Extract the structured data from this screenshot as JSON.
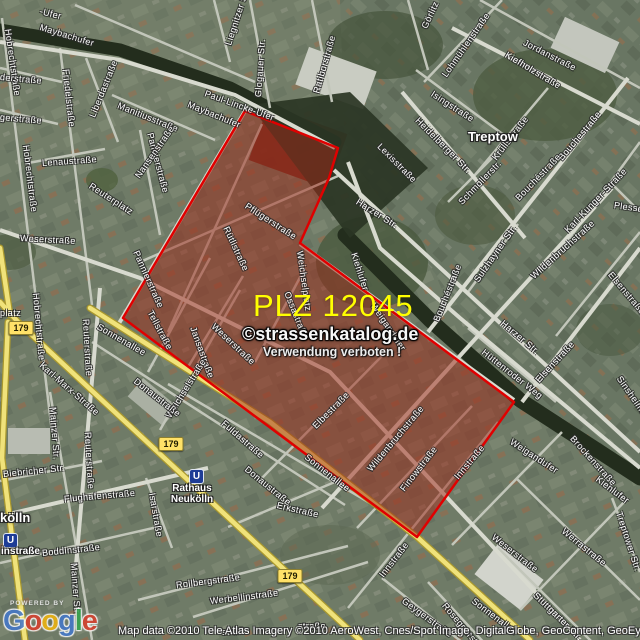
{
  "map": {
    "plz_label": "PLZ 12045",
    "plz_color": "#ffff00",
    "watermark": {
      "line1": "©strassenkatalog.de",
      "line2": "Verwendung verboten !"
    },
    "attribution": "Map data ©2010 Tele Atlas  Imagery ©2010 AeroWest, Cnes/Spot Image, DigitalGlobe, GeoContent, GeoEye,",
    "logo": {
      "powered_by": "POWERED BY",
      "letters": [
        {
          "ch": "G",
          "color": "#4478c9"
        },
        {
          "ch": "o",
          "color": "#d7402e"
        },
        {
          "ch": "o",
          "color": "#efb410"
        },
        {
          "ch": "g",
          "color": "#4478c9"
        },
        {
          "ch": "l",
          "color": "#36a44e"
        },
        {
          "ch": "e",
          "color": "#d7402e"
        }
      ]
    },
    "area_color": "#a02818",
    "area_border_color": "#e00000",
    "area_polygon": "245,111 338,148 329,178 300,243 514,402 417,537 123,318",
    "route_badges": [
      {
        "label": "179",
        "x": 21,
        "y": 328
      },
      {
        "label": "179",
        "x": 171,
        "y": 444
      },
      {
        "label": "179",
        "x": 290,
        "y": 576
      }
    ],
    "stations": [
      {
        "display": "instraße",
        "icon": {
          "x": 3,
          "y": 533
        },
        "label": {
          "x": 1,
          "y": 546,
          "w": 44,
          "align": "left"
        }
      },
      {
        "display": "Rathaus\nNeukölln",
        "icon": {
          "x": 189,
          "y": 469
        },
        "label": {
          "x": 161,
          "y": 483,
          "w": 62,
          "align": "center"
        }
      }
    ],
    "places": [
      {
        "t": "Treptow",
        "x": 468,
        "y": 129
      },
      {
        "t": "kölln",
        "x": 0,
        "y": 510
      }
    ],
    "streets": [
      {
        "t": "-Ufer",
        "x": 40,
        "y": 6,
        "r": 14
      },
      {
        "t": "Maybachufer",
        "x": 40,
        "y": 22,
        "r": 17
      },
      {
        "t": "Hobrechtstraße",
        "x": 8,
        "y": 24,
        "r": 82
      },
      {
        "t": "derstraße",
        "x": 0,
        "y": 72,
        "r": 5
      },
      {
        "t": "gerstraße",
        "x": 0,
        "y": 112,
        "r": 5
      },
      {
        "t": "Hobrechtstraße",
        "x": 26,
        "y": 140,
        "r": 83
      },
      {
        "t": "Friedelstraße",
        "x": 66,
        "y": 64,
        "r": 84
      },
      {
        "t": "Liberdastraße",
        "x": 92,
        "y": 112,
        "r": -68
      },
      {
        "t": "Manitiusstraße",
        "x": 118,
        "y": 100,
        "r": 22
      },
      {
        "t": "Pannierstraße",
        "x": 150,
        "y": 128,
        "r": 75
      },
      {
        "t": "Pannierstraße",
        "x": 136,
        "y": 246,
        "r": 66
      },
      {
        "t": "Liegnitzer Str.",
        "x": 228,
        "y": 40,
        "r": -72
      },
      {
        "t": "Glogauer Str.",
        "x": 258,
        "y": 92,
        "r": -86
      },
      {
        "t": "Ratiborstraße",
        "x": 316,
        "y": 88,
        "r": -74
      },
      {
        "t": "Paul-Lincke-Ufer",
        "x": 205,
        "y": 88,
        "r": 20
      },
      {
        "t": "Maybachufer",
        "x": 188,
        "y": 99,
        "r": 22
      },
      {
        "t": "Görlitz",
        "x": 424,
        "y": 23,
        "r": -65
      },
      {
        "t": "Lohmühlenstraße",
        "x": 444,
        "y": 71,
        "r": -55
      },
      {
        "t": "Jordanstraße",
        "x": 524,
        "y": 37,
        "r": 27
      },
      {
        "t": "Kiefholzstraße",
        "x": 506,
        "y": 49,
        "r": 31
      },
      {
        "t": "Isingstraße",
        "x": 432,
        "y": 88,
        "r": 33
      },
      {
        "t": "Krüllsstraße",
        "x": 494,
        "y": 154,
        "r": -52
      },
      {
        "t": "Heidelberger Str.",
        "x": 417,
        "y": 114,
        "r": 45
      },
      {
        "t": "Bouchestraße",
        "x": 560,
        "y": 154,
        "r": -50
      },
      {
        "t": "Bouchéstraße",
        "x": 517,
        "y": 194,
        "r": -46
      },
      {
        "t": "Bouchéstraße",
        "x": 436,
        "y": 316,
        "r": -68
      },
      {
        "t": "Karl-Kunger-Straße",
        "x": 566,
        "y": 226,
        "r": -46
      },
      {
        "t": "Plesser Str.",
        "x": 614,
        "y": 200,
        "r": 8
      },
      {
        "t": "Schmollerstr.",
        "x": 460,
        "y": 198,
        "r": -46
      },
      {
        "t": "Sulzhayner Str.",
        "x": 476,
        "y": 276,
        "r": -55
      },
      {
        "t": "Wildenbruchstraße",
        "x": 532,
        "y": 272,
        "r": -42
      },
      {
        "t": "Elsenstraße",
        "x": 537,
        "y": 376,
        "r": -47
      },
      {
        "t": "Elsenstraße",
        "x": 610,
        "y": 268,
        "r": 50
      },
      {
        "t": "Harzer Str.",
        "x": 357,
        "y": 196,
        "r": 32
      },
      {
        "t": "Harzer Str.",
        "x": 502,
        "y": 317,
        "r": 40
      },
      {
        "t": "Hüttenroder Weg",
        "x": 483,
        "y": 346,
        "r": 38
      },
      {
        "t": "Kiehlufer",
        "x": 354,
        "y": 248,
        "r": 72
      },
      {
        "t": "Kiehlufer",
        "x": 597,
        "y": 473,
        "r": 37
      },
      {
        "t": "Weigandufer",
        "x": 373,
        "y": 299,
        "r": 56
      },
      {
        "t": "Weigandufer",
        "x": 511,
        "y": 436,
        "r": 33
      },
      {
        "t": "Weichselplatz",
        "x": 300,
        "y": 246,
        "r": 82
      },
      {
        "t": "Sinsheimer Str.",
        "x": 619,
        "y": 372,
        "r": 55
      },
      {
        "t": "Brockenstraße",
        "x": 572,
        "y": 432,
        "r": 48
      },
      {
        "t": "Treptower Str.",
        "x": 619,
        "y": 507,
        "r": 72
      },
      {
        "t": "Lexisstraße",
        "x": 379,
        "y": 140,
        "r": 45
      },
      {
        "t": "Pflügerstraße",
        "x": 246,
        "y": 200,
        "r": 33
      },
      {
        "t": "Rütlistraße",
        "x": 226,
        "y": 222,
        "r": 65
      },
      {
        "t": "Ossastraße",
        "x": 287,
        "y": 287,
        "r": 68
      },
      {
        "t": "Tellstraße",
        "x": 150,
        "y": 306,
        "r": 62
      },
      {
        "t": "Jansastraße",
        "x": 193,
        "y": 322,
        "r": 70
      },
      {
        "t": "Weichselstraße",
        "x": 168,
        "y": 412,
        "r": -58
      },
      {
        "t": "Weserstraße",
        "x": 20,
        "y": 233,
        "r": 3
      },
      {
        "t": "Weserstraße",
        "x": 213,
        "y": 320,
        "r": 43
      },
      {
        "t": "Weserstraße",
        "x": 493,
        "y": 531,
        "r": 38
      },
      {
        "t": "Sonnenallee",
        "x": 98,
        "y": 321,
        "r": 30
      },
      {
        "t": "Sonnenallee",
        "x": 306,
        "y": 451,
        "r": 38
      },
      {
        "t": "Sonnenallee",
        "x": 473,
        "y": 595,
        "r": 37
      },
      {
        "t": "Elbestraße",
        "x": 314,
        "y": 422,
        "r": -45
      },
      {
        "t": "Wildenbruchstraße",
        "x": 369,
        "y": 465,
        "r": -50
      },
      {
        "t": "Finowstraße",
        "x": 402,
        "y": 485,
        "r": -52
      },
      {
        "t": "Innstraße",
        "x": 456,
        "y": 473,
        "r": -50
      },
      {
        "t": "Innstraße",
        "x": 381,
        "y": 571,
        "r": -52
      },
      {
        "t": "Geygerstraße",
        "x": 403,
        "y": 595,
        "r": 36
      },
      {
        "t": "Erkstraße",
        "x": 277,
        "y": 500,
        "r": 13
      },
      {
        "t": "Donaustraße",
        "x": 135,
        "y": 375,
        "r": 38
      },
      {
        "t": "Donaustraße",
        "x": 246,
        "y": 463,
        "r": 39
      },
      {
        "t": "Fuldastraße",
        "x": 223,
        "y": 417,
        "r": 41
      },
      {
        "t": "Karl-Marx-Straße",
        "x": 41,
        "y": 359,
        "r": 41
      },
      {
        "t": "Mainzer Str.",
        "x": 53,
        "y": 402,
        "r": 86
      },
      {
        "t": "Mainzer Str.",
        "x": 74,
        "y": 558,
        "r": 86
      },
      {
        "t": "Reuterstraße",
        "x": 86,
        "y": 314,
        "r": 87
      },
      {
        "t": "Reuterstraße",
        "x": 88,
        "y": 427,
        "r": 87
      },
      {
        "t": "Reuterplatz",
        "x": 90,
        "y": 180,
        "r": 33
      },
      {
        "t": "Lenaustraße",
        "x": 42,
        "y": 158,
        "r": -4
      },
      {
        "t": "Nansenstraße",
        "x": 137,
        "y": 172,
        "r": -55
      },
      {
        "t": "platz",
        "x": 0,
        "y": 308,
        "r": 0
      },
      {
        "t": "Biebricher Str.",
        "x": 3,
        "y": 469,
        "r": -6
      },
      {
        "t": "Flughafenstraße",
        "x": 64,
        "y": 494,
        "r": -5
      },
      {
        "t": "Isarstraße",
        "x": 152,
        "y": 488,
        "r": 80
      },
      {
        "t": "Boddinstraße",
        "x": 42,
        "y": 548,
        "r": -6
      },
      {
        "t": "Rollbergstraße",
        "x": 176,
        "y": 580,
        "r": -7
      },
      {
        "t": "Werbellinstraße",
        "x": 210,
        "y": 596,
        "r": -7
      },
      {
        "t": "straße",
        "x": 222,
        "y": 627,
        "r": -3
      },
      {
        "t": "straße",
        "x": 298,
        "y": 621,
        "r": 0
      },
      {
        "t": "Werrastraße",
        "x": 563,
        "y": 525,
        "r": 39
      },
      {
        "t": "Stuttgarter Str.",
        "x": 535,
        "y": 589,
        "r": 44
      },
      {
        "t": "Roseggerstraße",
        "x": 444,
        "y": 599,
        "r": 50
      },
      {
        "t": "Hobrechtstraße",
        "x": 36,
        "y": 288,
        "r": 85
      }
    ]
  }
}
